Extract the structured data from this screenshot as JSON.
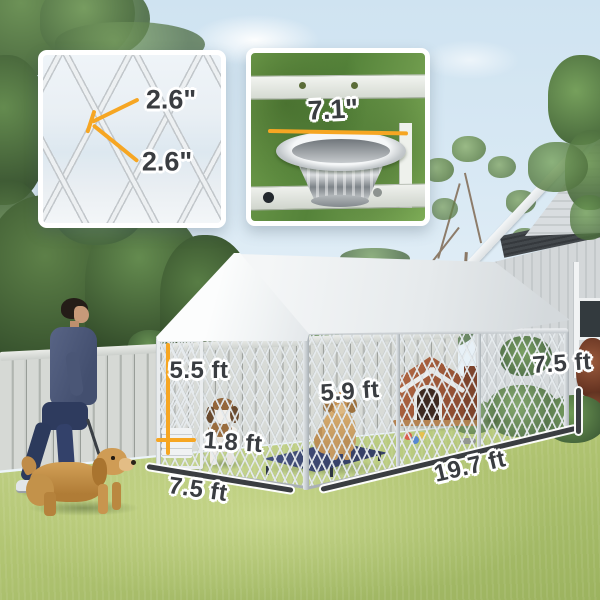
{
  "insets": {
    "mesh_detail": {
      "measure_top": "2.6\"",
      "measure_bottom": "2.6\""
    },
    "bowl_detail": {
      "bowl_diameter": "7.1\""
    }
  },
  "kennel_dimensions": {
    "door_height": "5.5 ft",
    "door_width": "1.8 ft",
    "front_width": "7.5 ft",
    "interior_height": "5.9 ft",
    "run_length": "19.7 ft",
    "total_height": "7.5 ft"
  },
  "colors": {
    "measure_accent": "#F6A623",
    "measure_text": "#3A3D41",
    "canopy_white": "#F3F5F6",
    "grass_green": "#B4C67C",
    "sky_blue": "#D7E8F3"
  }
}
